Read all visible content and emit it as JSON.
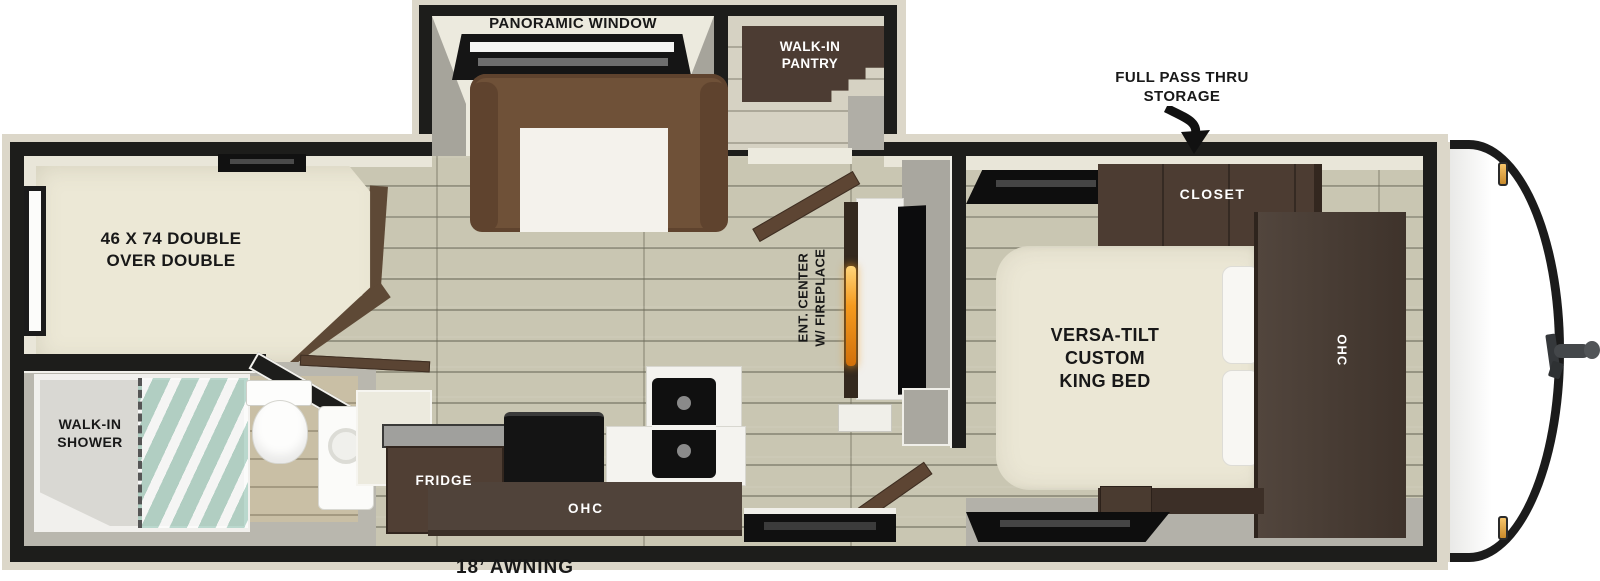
{
  "title": "Travel trailer floor plan",
  "labels": {
    "panoramic_window": "PANORAMIC WINDOW",
    "walk_in_pantry": "WALK-IN\nPANTRY",
    "full_pass_thru_storage": "FULL PASS THRU\nSTORAGE",
    "closet": "CLOSET",
    "bunk_bed": "46 X 74 DOUBLE\nOVER DOUBLE",
    "king_bed": "VERSA-TILT\nCUSTOM\nKING BED",
    "ohc_bedroom": "OHC",
    "ent_center": "ENT. CENTER\nW/ FIREPLACE",
    "walk_in_shower": "WALK-IN\nSHOWER",
    "fridge": "FRIDGE",
    "ohc_kitchen": "OHC",
    "awning": "18’ AWNING"
  },
  "palette": {
    "wall_black": "#1d1d1b",
    "exterior_trim": "#dcd7c9",
    "interior_wall_face": "#e9e6d9",
    "gray_wall": "#a9a79f",
    "floor_wood": "#c9c6b2",
    "floor_light": "#d6d2c3",
    "bath_floor": "#b9b7ae",
    "cabinet_dark": "#4a3a31",
    "sofa_brown": "#6f5138",
    "mattress_cream": "#ece8d6",
    "counter_white": "#f4f3ef",
    "appliance_black": "#121212",
    "shower_glass": "#bfe3d8",
    "flame_orange": "#f59a1e",
    "marker_light_amber": "#eeaf4d"
  }
}
